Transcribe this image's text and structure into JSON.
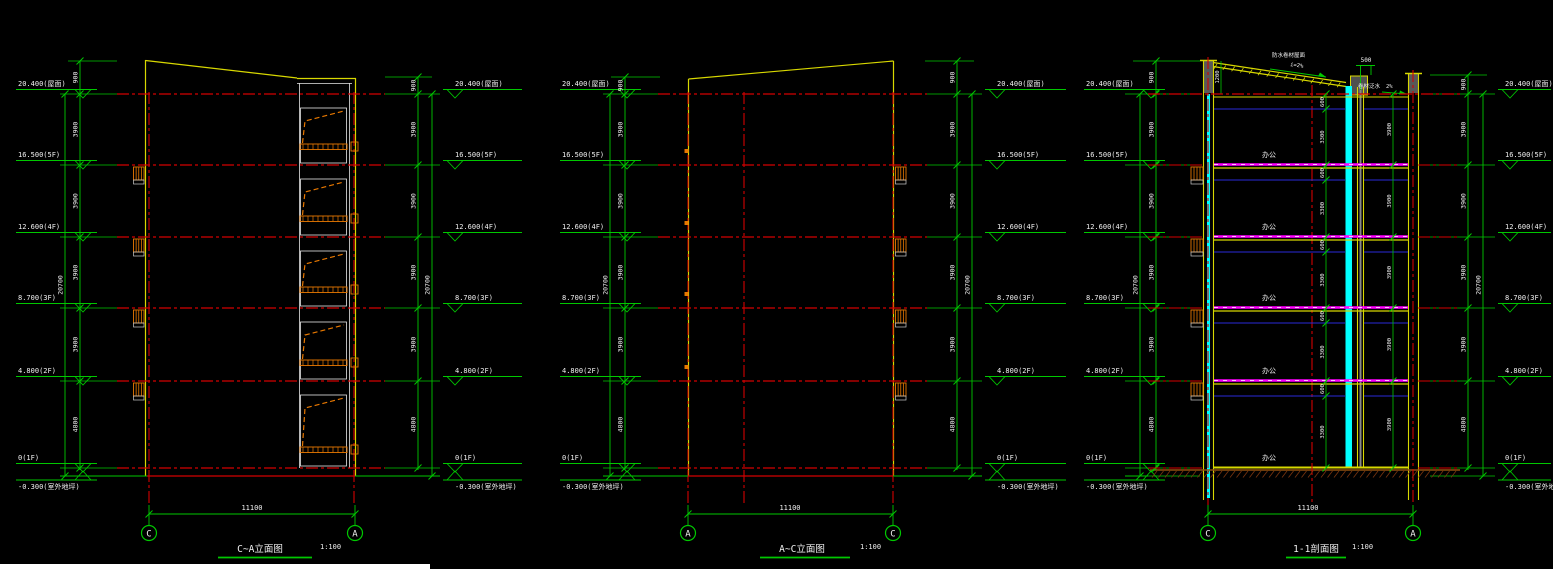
{
  "app": {
    "background": "#000000"
  },
  "levels": [
    "20.400(屋面)",
    "16.500(5F)",
    "12.600(4F)",
    "8.700(3F)",
    "4.800(2F)",
    "0(1F)",
    "-0.300(室外地坪)"
  ],
  "dims": {
    "story": [
      "900",
      "3900",
      "3900",
      "3900",
      "3900",
      "4800"
    ],
    "overall": "20700",
    "width": "11100",
    "penthouse": "500",
    "parapet_left": "1200",
    "interior": [
      "600",
      "3300"
    ],
    "interior_story": "3900"
  },
  "drawings": [
    {
      "title": "C~A立面图",
      "scale": "1:100",
      "bubbles": [
        "C",
        "A"
      ]
    },
    {
      "title": "A~C立面图",
      "scale": "1:100",
      "bubbles": [
        "A",
        "C"
      ]
    },
    {
      "title": "1-1剖面图",
      "scale": "1:100",
      "bubbles": [
        "C",
        "A"
      ],
      "room": "办公",
      "annotations": {
        "roof_material": "防水卷材屋面",
        "slope": "i=2%",
        "slope_right": "2%",
        "flashing": "卷材泛水"
      }
    }
  ],
  "colors": {
    "dimension_green": "#00c800",
    "grid_red": "#d40000",
    "outline_yellow": "#d8d800",
    "stair_orange": "#e87800",
    "slab_magenta": "#ff00ff",
    "column_cyan": "#00ffff",
    "ceiling_blue": "#2a2ad8",
    "text_white": "#f0f0f0"
  }
}
